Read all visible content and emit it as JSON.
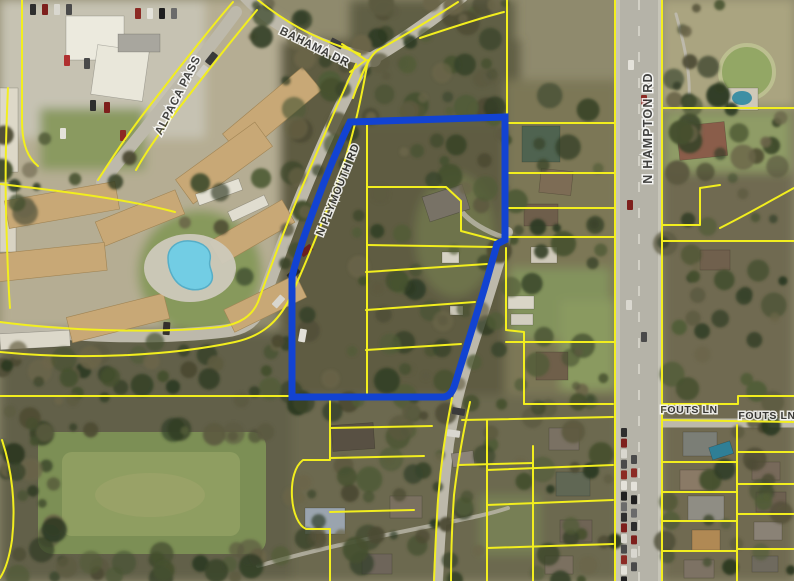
{
  "map": {
    "street_labels": [
      {
        "id": "bahama-dr",
        "text": "BAHAMA DR"
      },
      {
        "id": "alpaca-pass",
        "text": "ALPACA PASS"
      },
      {
        "id": "n-plymouth-rd",
        "text": "N PLYMOUTH RD"
      },
      {
        "id": "n-hampton-rd",
        "text": "N HAMPTON RD"
      },
      {
        "id": "fouts-ln-west",
        "text": "FOUTS LN"
      },
      {
        "id": "fouts-ln-east",
        "text": "FOUTS LN"
      }
    ],
    "colors": {
      "parcel_line": "#f2ee1e",
      "highlight_parcel": "#1243d2",
      "label_text": "#2d2d2d",
      "label_halo": "#ffffff"
    }
  }
}
